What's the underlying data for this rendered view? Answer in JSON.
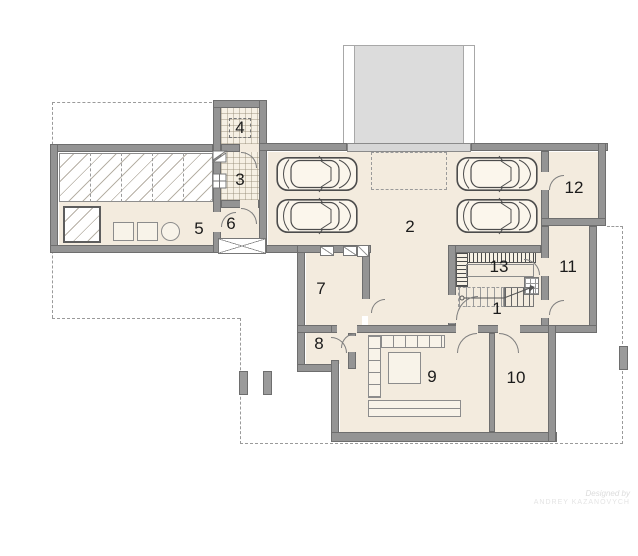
{
  "plan": {
    "type": "architectural floor plan (basement / garage level)",
    "rooms": [
      {
        "number": "1"
      },
      {
        "number": "2"
      },
      {
        "number": "3"
      },
      {
        "number": "4"
      },
      {
        "number": "5"
      },
      {
        "number": "6"
      },
      {
        "number": "7"
      },
      {
        "number": "8"
      },
      {
        "number": "9"
      },
      {
        "number": "10"
      },
      {
        "number": "11"
      },
      {
        "number": "12"
      },
      {
        "number": "13"
      }
    ],
    "garage_car_count": 4,
    "watermark": {
      "line1": "Designed by",
      "line2": "Andrey Kazanovych"
    },
    "colors": {
      "wall": "#949494",
      "floor": "#f3ebde",
      "ramp": "#dcdcdc",
      "hatch_line": "#b7b1a6",
      "dashed_outline": "#9a9a9a",
      "label_text": "#1b1b1b"
    }
  }
}
